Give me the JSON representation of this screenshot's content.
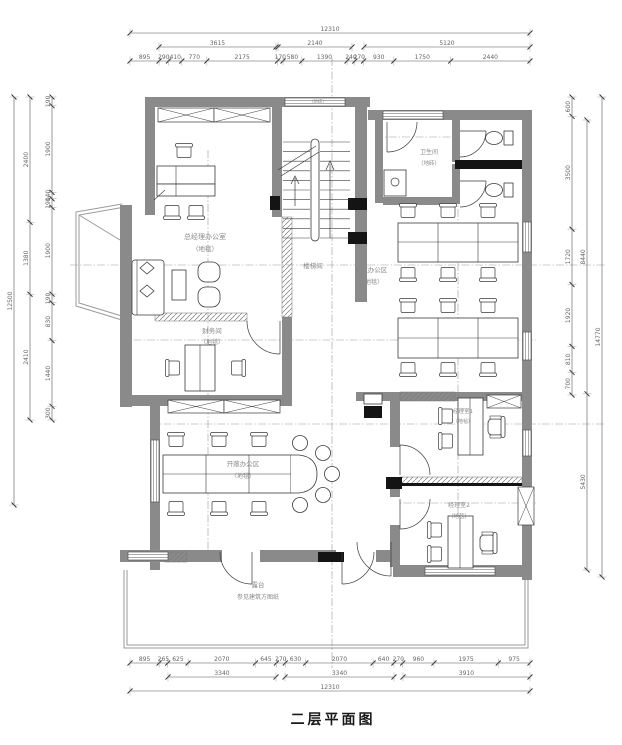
{
  "title": "二层平面图",
  "rooms": {
    "gm_office": {
      "name": "总经理办公室",
      "floor": "（地毯）"
    },
    "finance": {
      "name": "财务间",
      "floor": "（地毯）"
    },
    "stairwell": {
      "name": "楼梯间",
      "floor": "（地砖）"
    },
    "toilet": {
      "name": "卫生间",
      "floor": "（地砖）"
    },
    "open_office_right": {
      "name": "开敞办公区",
      "floor": "（地毯）"
    },
    "open_office_left": {
      "name": "开敞办公区",
      "floor": "（地毯）"
    },
    "manager1": {
      "name": "经理室1",
      "floor": "（地毯）"
    },
    "manager2": {
      "name": "经理室2",
      "floor": "（地毯）"
    },
    "terrace": {
      "name": "露台",
      "note": "参见建筑方图纸"
    }
  },
  "dimensions": {
    "top": {
      "overall": "12310",
      "group1": "3615",
      "group2": "2140",
      "group3": "5120",
      "segments": [
        "895",
        "290",
        "410",
        "770",
        "2175",
        "170",
        "580",
        "1390",
        "240",
        "270",
        "930",
        "1750",
        "2440"
      ]
    },
    "bottom": {
      "overall": "12310",
      "group1": "3340",
      "group2": "3340",
      "group3": "3910",
      "segments": [
        "895",
        "265",
        "625",
        "2070",
        "645",
        "270",
        "630",
        "2070",
        "640",
        "270",
        "960",
        "1975",
        "975"
      ]
    },
    "left": {
      "overall": "12500",
      "groups": [
        "2400",
        "1380",
        "2410"
      ],
      "segments": [
        "190",
        "1900",
        "140",
        "190",
        "1900",
        "190",
        "830",
        "1440",
        "300"
      ]
    },
    "right": {
      "overall": "14770",
      "groups": [
        "8440",
        "5430"
      ],
      "segments": [
        "600",
        "3500",
        "1720",
        "1920",
        "810",
        "700"
      ]
    }
  },
  "colors": {
    "wall": "#8a8a8a",
    "line": "#3a3a3a",
    "dim_text": "#666666",
    "accent": "#141414",
    "axis": "#999999"
  }
}
